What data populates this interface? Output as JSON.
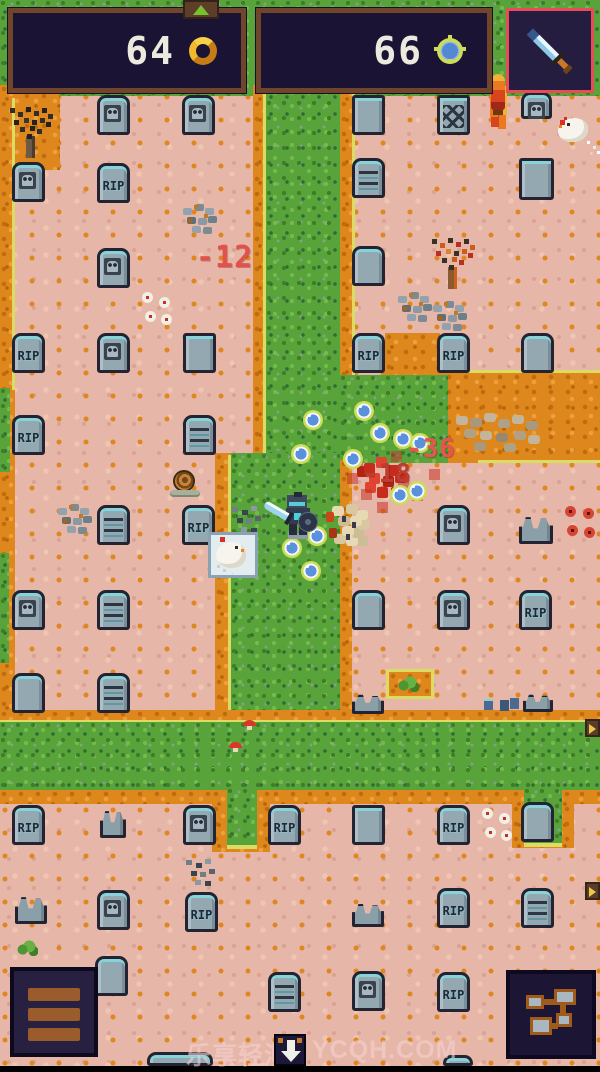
{
  "hud": {
    "gold_count": "64",
    "gem_count": "66",
    "gold_icon": "gold-ring-coin",
    "gem_icon": "blue-gem-coin",
    "weapon_icon": "sword",
    "weapon_slot_accent": "#ea4b58"
  },
  "indicators": {
    "up_arrow": "up-arrow",
    "down_arrow": "down-arrow",
    "right_arrows": 2
  },
  "buttons": {
    "menu": "hamburger-menu",
    "map": "dungeon-map"
  },
  "watermark": {
    "brand": "乐享轻汇",
    "site": "YCQH.COM"
  },
  "colors": {
    "damage_red": "#e2524a",
    "grass": "#58a43a",
    "dirt_orange": "#dd871d",
    "ground_pink": "#e6b7a8",
    "hud_panel": "#1a1334",
    "hud_border": "#70452c"
  },
  "damage_numbers": [
    {
      "value": "-12",
      "x": 196,
      "y": 240,
      "size": 30,
      "color": "#e2524a"
    },
    {
      "value": "-36",
      "x": 406,
      "y": 434,
      "size": 26,
      "color": "#e8544e"
    },
    {
      "value": "-18",
      "x": 362,
      "y": 459,
      "size": 26,
      "color": "#bf3c30"
    }
  ],
  "scene": {
    "entities": [
      {
        "k": "tomb",
        "t": "skull",
        "x": 97,
        "y": 95
      },
      {
        "k": "tomb",
        "t": "skull",
        "x": 182,
        "y": 95
      },
      {
        "k": "tomb",
        "t": "square",
        "x": 352,
        "y": 95
      },
      {
        "k": "tomb",
        "t": "bricks",
        "x": 437,
        "y": 95
      },
      {
        "k": "tomb",
        "t": "skull",
        "x": 521,
        "y": 92,
        "w": 31,
        "h": 27
      },
      {
        "k": "tomb",
        "t": "skull",
        "x": 12,
        "y": 162
      },
      {
        "k": "tomb",
        "t": "rip",
        "x": 97,
        "y": 163,
        "label": "RIP"
      },
      {
        "k": "tomb",
        "t": "lines",
        "x": 352,
        "y": 158
      },
      {
        "k": "tomb",
        "t": "square",
        "x": 519,
        "y": 158,
        "w": 35,
        "h": 42
      },
      {
        "k": "tomb",
        "t": "skull",
        "x": 97,
        "y": 248
      },
      {
        "k": "tomb",
        "t": "blank",
        "x": 352,
        "y": 246
      },
      {
        "k": "tomb",
        "t": "rip",
        "x": 12,
        "y": 333,
        "label": "RIP"
      },
      {
        "k": "tomb",
        "t": "skull",
        "x": 97,
        "y": 333
      },
      {
        "k": "tomb",
        "t": "square",
        "x": 183,
        "y": 333
      },
      {
        "k": "tomb",
        "t": "rip",
        "x": 352,
        "y": 333,
        "label": "RIP"
      },
      {
        "k": "tomb",
        "t": "rip",
        "x": 437,
        "y": 333,
        "label": "RIP"
      },
      {
        "k": "tomb",
        "t": "blank",
        "x": 521,
        "y": 333
      },
      {
        "k": "tomb",
        "t": "rip",
        "x": 12,
        "y": 415,
        "label": "RIP"
      },
      {
        "k": "tomb",
        "t": "lines",
        "x": 183,
        "y": 415
      },
      {
        "k": "tomb",
        "t": "lines",
        "x": 97,
        "y": 505
      },
      {
        "k": "tomb",
        "t": "rip",
        "x": 182,
        "y": 505,
        "label": "RIP"
      },
      {
        "k": "tomb",
        "t": "skull",
        "x": 437,
        "y": 505
      },
      {
        "k": "tomb",
        "t": "broken",
        "x": 519,
        "y": 516,
        "w": 34,
        "h": 28
      },
      {
        "k": "tomb",
        "t": "skull",
        "x": 12,
        "y": 590
      },
      {
        "k": "tomb",
        "t": "lines",
        "x": 97,
        "y": 590
      },
      {
        "k": "tomb",
        "t": "blank",
        "x": 352,
        "y": 590
      },
      {
        "k": "tomb",
        "t": "skull",
        "x": 437,
        "y": 590
      },
      {
        "k": "tomb",
        "t": "rip",
        "x": 519,
        "y": 590,
        "label": "RIP"
      },
      {
        "k": "tomb",
        "t": "blank",
        "x": 12,
        "y": 673
      },
      {
        "k": "tomb",
        "t": "lines",
        "x": 97,
        "y": 673
      },
      {
        "k": "tomb",
        "t": "broken",
        "x": 352,
        "y": 694,
        "w": 32,
        "h": 20
      },
      {
        "k": "tomb",
        "t": "broken",
        "x": 523,
        "y": 694,
        "w": 30,
        "h": 18
      },
      {
        "k": "tomb",
        "t": "rip",
        "x": 12,
        "y": 805,
        "label": "RIP"
      },
      {
        "k": "tomb",
        "t": "broken",
        "x": 100,
        "y": 810,
        "w": 26,
        "h": 28
      },
      {
        "k": "tomb",
        "t": "skull",
        "x": 183,
        "y": 805
      },
      {
        "k": "tomb",
        "t": "rip",
        "x": 268,
        "y": 805,
        "label": "RIP"
      },
      {
        "k": "tomb",
        "t": "square",
        "x": 352,
        "y": 805
      },
      {
        "k": "tomb",
        "t": "rip",
        "x": 437,
        "y": 805,
        "label": "RIP"
      },
      {
        "k": "tomb",
        "t": "blank",
        "x": 521,
        "y": 802
      },
      {
        "k": "tomb",
        "t": "broken",
        "x": 15,
        "y": 896,
        "w": 32,
        "h": 28
      },
      {
        "k": "tomb",
        "t": "skull",
        "x": 97,
        "y": 890
      },
      {
        "k": "tomb",
        "t": "rip",
        "x": 185,
        "y": 892,
        "label": "RIP"
      },
      {
        "k": "tomb",
        "t": "broken",
        "x": 352,
        "y": 903,
        "w": 32,
        "h": 24
      },
      {
        "k": "tomb",
        "t": "rip",
        "x": 437,
        "y": 888,
        "label": "RIP"
      },
      {
        "k": "tomb",
        "t": "lines",
        "x": 521,
        "y": 888
      },
      {
        "k": "tomb",
        "t": "blank",
        "x": 95,
        "y": 956
      },
      {
        "k": "tomb",
        "t": "lines",
        "x": 268,
        "y": 972
      },
      {
        "k": "tomb",
        "t": "skull",
        "x": 352,
        "y": 971
      },
      {
        "k": "tomb",
        "t": "rip",
        "x": 437,
        "y": 972,
        "label": "RIP"
      },
      {
        "k": "tomb",
        "t": "blank",
        "x": 147,
        "y": 1052,
        "w": 66,
        "h": 14
      },
      {
        "k": "tomb",
        "t": "blank",
        "x": 443,
        "y": 1055,
        "w": 30,
        "h": 11
      },
      {
        "k": "rocks",
        "x": 180,
        "y": 203
      },
      {
        "k": "rocks",
        "x": 395,
        "y": 291
      },
      {
        "k": "rocks",
        "x": 430,
        "y": 300,
        "w": 44,
        "h": 32
      },
      {
        "k": "rocks",
        "x": 55,
        "y": 503
      },
      {
        "k": "rockpile",
        "x": 452,
        "y": 408
      },
      {
        "k": "debris",
        "x": 228,
        "y": 503
      },
      {
        "k": "debris",
        "x": 182,
        "y": 856
      },
      {
        "k": "debris-blue",
        "x": 482,
        "y": 697
      },
      {
        "k": "pinwheels",
        "x": 140,
        "y": 290
      },
      {
        "k": "pinwheels",
        "x": 480,
        "y": 806
      },
      {
        "k": "redflowers",
        "x": 563,
        "y": 504
      },
      {
        "k": "mushroom",
        "x": 243,
        "y": 720
      },
      {
        "k": "mushroom",
        "x": 229,
        "y": 742
      },
      {
        "k": "bush",
        "x": 397,
        "y": 676
      },
      {
        "k": "bush",
        "x": 16,
        "y": 940
      },
      {
        "k": "tree",
        "t": "dead",
        "x": 8,
        "y": 106
      },
      {
        "k": "tree",
        "t": "autumn",
        "x": 430,
        "y": 237
      },
      {
        "k": "flame",
        "x": 486,
        "y": 72
      },
      {
        "k": "snail",
        "x": 170,
        "y": 470
      },
      {
        "k": "blood",
        "x": 348,
        "y": 453
      },
      {
        "k": "redtile",
        "x": 347,
        "y": 473
      },
      {
        "k": "redtile",
        "x": 361,
        "y": 489
      },
      {
        "k": "redtile",
        "x": 377,
        "y": 502
      },
      {
        "k": "redtile",
        "x": 398,
        "y": 477
      },
      {
        "k": "redtile",
        "x": 412,
        "y": 490
      },
      {
        "k": "redtile",
        "x": 429,
        "y": 469
      },
      {
        "k": "redtile",
        "x": 352,
        "y": 456
      },
      {
        "k": "redtile",
        "x": 391,
        "y": 451
      },
      {
        "k": "gem",
        "x": 354,
        "y": 401
      },
      {
        "k": "gem",
        "x": 370,
        "y": 423
      },
      {
        "k": "gem",
        "x": 393,
        "y": 429
      },
      {
        "k": "gem",
        "x": 410,
        "y": 433
      },
      {
        "k": "gem",
        "x": 343,
        "y": 449
      },
      {
        "k": "gem",
        "x": 291,
        "y": 444
      },
      {
        "k": "gem",
        "x": 303,
        "y": 410
      },
      {
        "k": "gem",
        "x": 390,
        "y": 485
      },
      {
        "k": "gem",
        "x": 407,
        "y": 481
      },
      {
        "k": "gem",
        "x": 282,
        "y": 538
      },
      {
        "k": "gem",
        "x": 301,
        "y": 561
      },
      {
        "k": "gem",
        "x": 307,
        "y": 526
      },
      {
        "k": "bonepile",
        "x": 328,
        "y": 502
      },
      {
        "k": "chicken",
        "x": 556,
        "y": 112
      },
      {
        "k": "chicken-tile",
        "x": 208,
        "y": 532
      },
      {
        "k": "player",
        "x": 276,
        "y": 492
      },
      {
        "k": "arrow-right",
        "x": 585,
        "y": 719
      },
      {
        "k": "arrow-right",
        "x": 585,
        "y": 882
      }
    ]
  }
}
